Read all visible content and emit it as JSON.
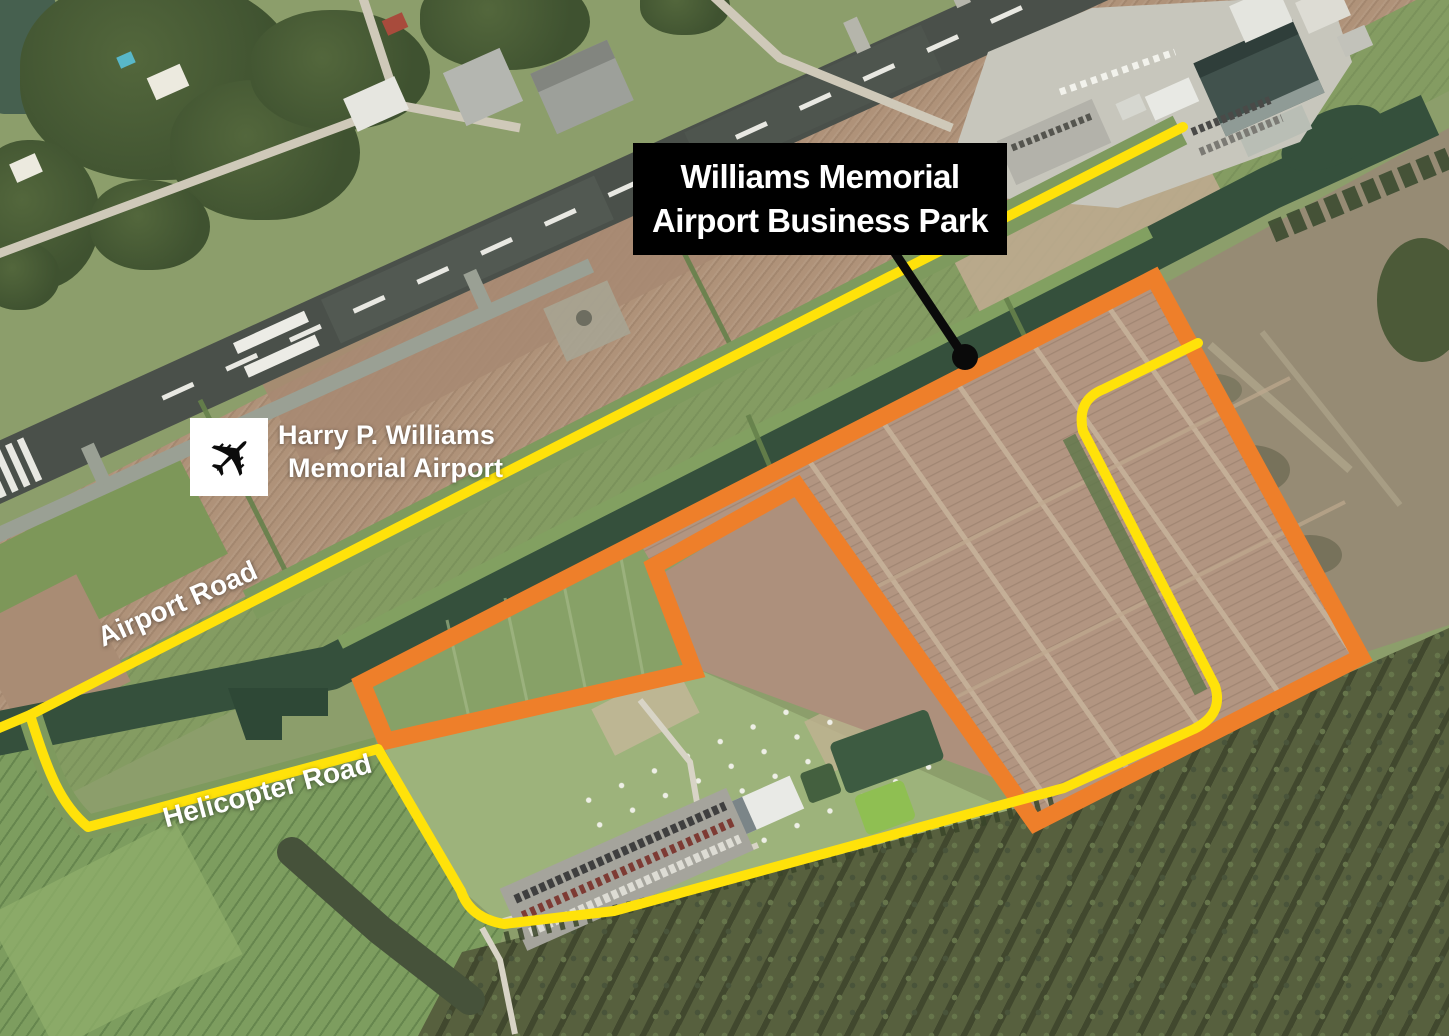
{
  "map": {
    "title": {
      "line1": "Williams Memorial",
      "line2": "Airport Business Park"
    },
    "airport": {
      "icon": "airplane-icon",
      "name_line1": "Harry P. Williams",
      "name_line2": "Memorial Airport"
    },
    "roads": [
      {
        "label": "Airport Road"
      },
      {
        "label": "Helicopter Road"
      }
    ],
    "colors": {
      "business_park_outline": "#EE7F2A",
      "road_highlight": "#FFE20A",
      "label_box_background": "#000000",
      "label_text": "#FFFFFF"
    }
  }
}
